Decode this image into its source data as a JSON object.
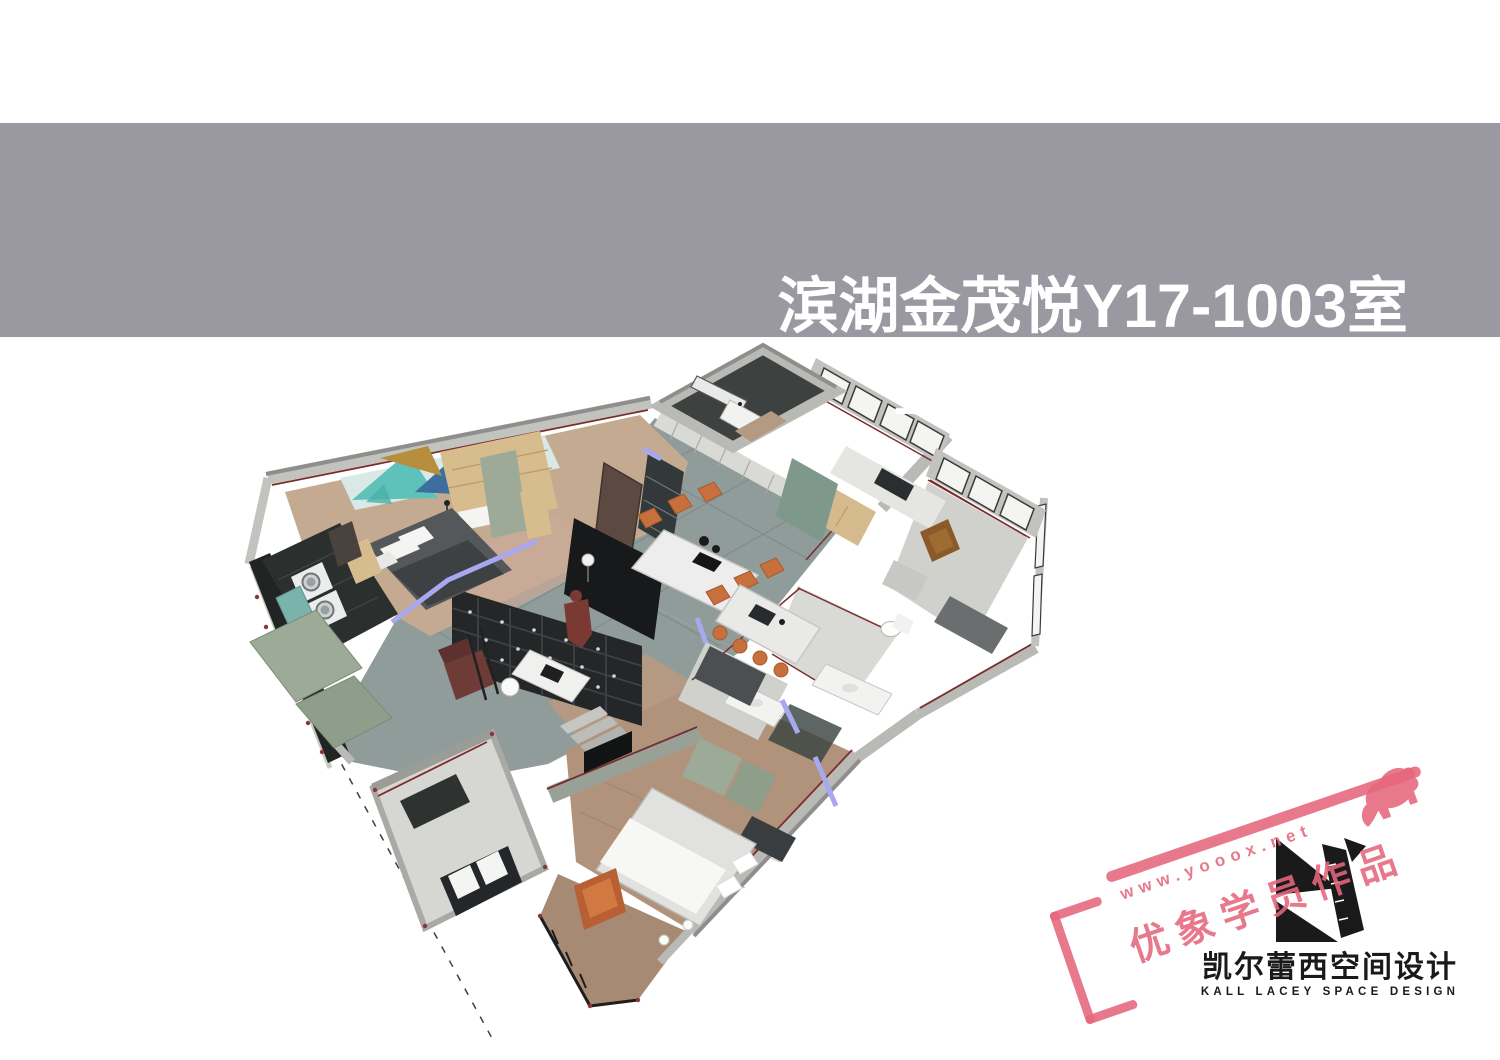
{
  "page": {
    "background": "#ffffff"
  },
  "banner": {
    "title_line1": "滨湖金茂悦Y17-1003室",
    "title_line2": "室内设计施工图纸",
    "background": "#9a98a1",
    "text_color": "#ffffff"
  },
  "model": {
    "description": "3D axonometric SketchUp-style cutaway of apartment Y17-1003 interior",
    "rooms": [
      "entry-balcony",
      "kitchen",
      "dining-room",
      "living-room",
      "left-bedroom",
      "laundry-balcony",
      "study",
      "bathroom",
      "master-bedroom",
      "master-balcony",
      "bay-window"
    ],
    "colors": {
      "wall_band": "#c2c3bf",
      "wall_top": "#8e8f8c",
      "tile_floor": "#8f9c9a",
      "wood_floor": "#b1927b",
      "wood_light": "#c3aa90",
      "bookshelf_dark": "#242628",
      "sage_cabinet": "#9caa97",
      "tan_wood": "#d7bd8e",
      "teal_counter": "#7ab3ab",
      "art_teal": "#5fc2ba",
      "art_blue": "#3c6f9e",
      "art_mustard": "#b78d3e",
      "chair_orange": "#c8703d",
      "section_cut_red": "#7b2d2d",
      "door_accent_periwinkle": "#a8a8f0",
      "person_figure": "#7a3a33",
      "glass_white": "#f4f5f3",
      "window_frame": "#3a3a3a"
    }
  },
  "watermark": {
    "url_text": "www.yooox.net",
    "label_text": "优象学员作品",
    "color": "#e5667c",
    "icon": "elephant-icon"
  },
  "logo": {
    "name_cn": "凯尔蕾西空间设计",
    "name_en": "KALL LACEY SPACE DESIGN",
    "color": "#1a1a1a",
    "icon": "k-ruler-logo-icon"
  }
}
